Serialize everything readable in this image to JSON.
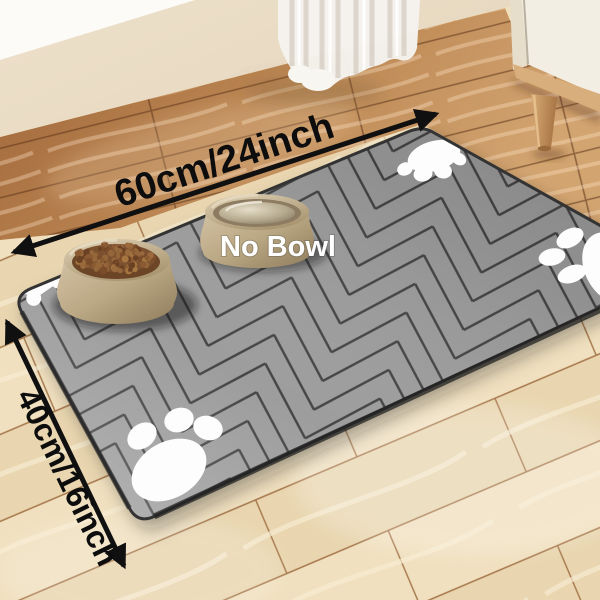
{
  "title": "Pet feeding mat product photo",
  "annotations": {
    "width_label": "60cm/24inch",
    "height_label": "40cm/16inch",
    "bowl_label": "No Bowl"
  },
  "scene": {
    "mat": "gray herringbone anti-slip pet feeding mat",
    "left_bowl": "pet bowl filled with kibble",
    "right_bowl": "pet bowl with water",
    "paw_print_count": 3,
    "bone_print_count": 1
  },
  "colors": {
    "arrow": "#101010",
    "dimension_text": "#0d0d0d",
    "bowl_label_text": "#ffffff",
    "mat_base": "#9d9d9d",
    "mat_lines": "#454545",
    "paw_print": "#fdfdfd",
    "floor_light": "#eedcbb",
    "floor_warm": "#b27445",
    "wall": "#eadec8",
    "curtain": "#f5f3ee",
    "cabinet": "#f2eee4",
    "bowl_tan": "#c3af92",
    "kibble_brown": "#8a5a33"
  }
}
